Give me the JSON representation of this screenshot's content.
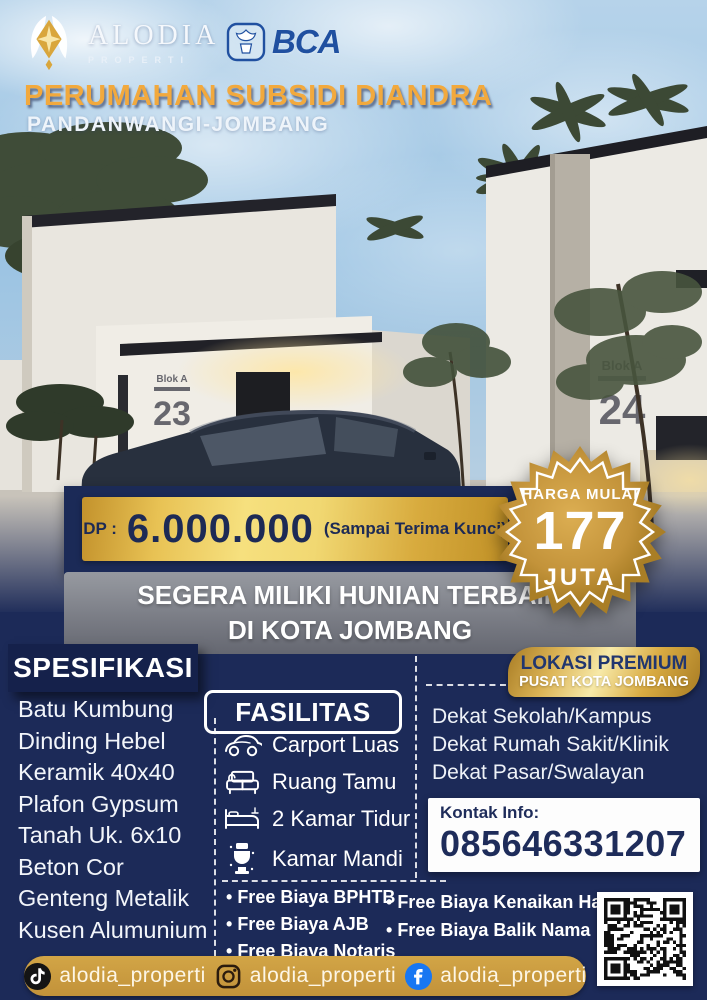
{
  "header": {
    "brand_name": "ALODIA",
    "brand_sub": "PROPERTI",
    "partner_name": "BCA",
    "title": "PERUMAHAN SUBSIDI DIANDRA",
    "subtitle": "PANDANWANGI-JOMBANG"
  },
  "render": {
    "house_left": {
      "label": "Blok A",
      "number": "23"
    },
    "house_right": {
      "label": "Blok A",
      "number": "24"
    }
  },
  "offer": {
    "dp_label": "DP :",
    "dp_value": "6.000.000",
    "dp_note": "(Sampai Terima Kunci)",
    "price_badge": {
      "top": "HARGA MULAI",
      "value": "177",
      "unit": "JUTA"
    },
    "tagline1": "SEGERA MILIKI HUNIAN TERBAIK",
    "tagline2": "DI KOTA JOMBANG"
  },
  "specifications": {
    "title": "SPESIFIKASI",
    "items": [
      "Batu Kumbung",
      "Dinding Hebel",
      "Keramik 40x40",
      "Plafon Gypsum",
      "Tanah Uk. 6x10",
      "Beton Cor",
      "Genteng Metalik",
      "Kusen Alumunium"
    ]
  },
  "facilities": {
    "title": "FASILITAS",
    "items": [
      {
        "icon": "car-icon",
        "label": "Carport Luas"
      },
      {
        "icon": "sofa-icon",
        "label": "Ruang Tamu"
      },
      {
        "icon": "bed-icon",
        "label": "2 Kamar Tidur"
      },
      {
        "icon": "toilet-icon",
        "label": "Kamar Mandi"
      }
    ]
  },
  "location": {
    "badge_title": "LOKASI PREMIUM",
    "badge_subtitle": "PUSAT KOTA JOMBANG",
    "items": [
      "Dekat Sekolah/Kampus",
      "Dekat Rumah Sakit/Klinik",
      "Dekat Pasar/Swalayan"
    ]
  },
  "contact": {
    "label": "Kontak Info:",
    "phone": "085646331207"
  },
  "perks": {
    "left": [
      "Free Biaya BPHTB",
      "Free Biaya AJB",
      "Free Biaya Notaris"
    ],
    "right": [
      "Free Biaya Kenaikan Hak",
      "Free Biaya Balik Nama"
    ]
  },
  "social": {
    "tiktok": "alodia_properti",
    "instagram": "alodia_properti",
    "facebook": "alodia_properti"
  },
  "colors": {
    "navy": "#1c2a58",
    "gold": "#c9973b",
    "title_gold": "#f2a93d",
    "bca_blue": "#2050a0",
    "facebook_blue": "#1877f2"
  }
}
